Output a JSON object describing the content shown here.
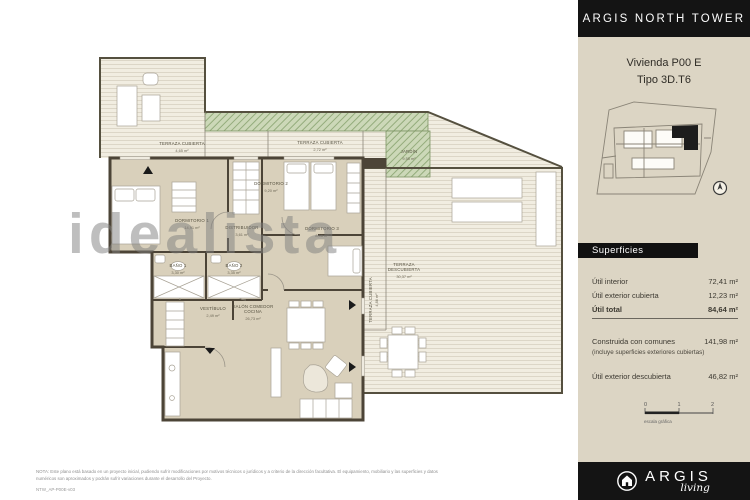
{
  "sidebar": {
    "building_title": "ARGIS NORTH TOWER",
    "unit_line1": "Vivienda P00 E",
    "unit_line2": "Tipo 3D.T6",
    "superficies": {
      "header": "Superficies",
      "rows": [
        {
          "label": "Útil interior",
          "value": "72,41 m²"
        },
        {
          "label": "Útil exterior cubierta",
          "value": "12,23 m²"
        },
        {
          "label": "Útil total",
          "value": "84,64 m²"
        },
        {
          "label": "Construida con comunes",
          "sublabel": "(incluye superficies exteriores cubiertas)",
          "value": "141,98 m²"
        },
        {
          "label": "Útil exterior descubierta",
          "value": "46,82 m²"
        }
      ]
    },
    "scale_bar": {
      "tick0": "0",
      "tick1": "1",
      "tick2": "2",
      "label": "escala gráfica"
    },
    "footer_logo": {
      "brand": "ARGIS",
      "sub": "living"
    }
  },
  "plan": {
    "watermark": "idealista",
    "rooms": [
      {
        "l1": "TERRAZA CUBIERTA",
        "area": "4,65 m²"
      },
      {
        "l1": "TERRAZA CUBIERTA",
        "area": "2,72 m²"
      },
      {
        "l1": "JARDÍN",
        "area": "9,55 m²"
      },
      {
        "l1": "DORMITORIO 1",
        "area": "14,91 m²"
      },
      {
        "l1": "DORMITORIO 2",
        "area": "9,20 m²"
      },
      {
        "l1": "DORMITORIO 3",
        "area": "8,06 m²"
      },
      {
        "l1": "DISTRIBUIDOR",
        "area": "3,61 m²"
      },
      {
        "l1": "BAÑO 1",
        "area": "3,30 m²"
      },
      {
        "l1": "BAÑO 2",
        "area": "3,35 m²"
      },
      {
        "l1": "VESTÍBULO",
        "area": "2,49 m²"
      },
      {
        "l1": "SALÓN COMEDOR",
        "l2": "COCINA",
        "area": "26,73 m²"
      },
      {
        "l1": "TERRAZA",
        "l2": "DESCUBIERTA",
        "area": "30,37 m²"
      },
      {
        "l1": "TERRAZA CUBIERTA",
        "area": "4,86 m²"
      }
    ],
    "note_line1": "NOTA: Este plano está basado en un proyecto inicial, pudiendo sufrir modificaciones por motivos técnicos o jurídicos y a criterio de la dirección facultativa. El equipamiento, mobiliario y las superficies y datos",
    "note_line2": "numéricos son aproximados y podrán sufrir variaciones durante el desarrollo del Proyecto.",
    "code": "NTW_AP-P00E-v03"
  }
}
